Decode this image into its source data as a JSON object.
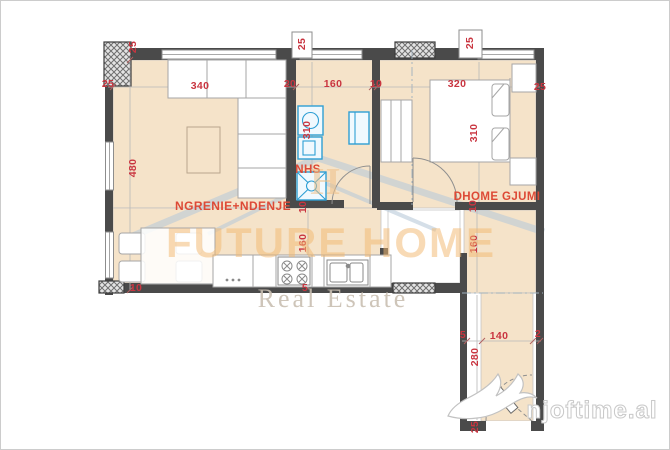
{
  "rooms": [
    {
      "id": "living-dining",
      "label": "NGRENIE+NDENJE",
      "x": 233,
      "y": 206
    },
    {
      "id": "bathroom",
      "label": "NHS",
      "x": 308,
      "y": 170
    },
    {
      "id": "bedroom",
      "label": "DHOME GJUMI",
      "x": 497,
      "y": 197
    }
  ],
  "dimension_labels": [
    {
      "text": "25",
      "x": 133,
      "y": 47,
      "rotated": true
    },
    {
      "text": "25",
      "x": 108,
      "y": 84,
      "rotated": false
    },
    {
      "text": "340",
      "x": 200,
      "y": 86,
      "rotated": false
    },
    {
      "text": "20",
      "x": 290,
      "y": 84,
      "rotated": false
    },
    {
      "text": "160",
      "x": 333,
      "y": 84,
      "rotated": false
    },
    {
      "text": "10",
      "x": 376,
      "y": 84,
      "rotated": false
    },
    {
      "text": "25",
      "x": 302,
      "y": 44,
      "rotated": true
    },
    {
      "text": "25",
      "x": 470,
      "y": 43,
      "rotated": true
    },
    {
      "text": "320",
      "x": 457,
      "y": 84,
      "rotated": false
    },
    {
      "text": "25",
      "x": 540,
      "y": 87,
      "rotated": false
    },
    {
      "text": "480",
      "x": 133,
      "y": 168,
      "rotated": true
    },
    {
      "text": "310",
      "x": 307,
      "y": 130,
      "rotated": true
    },
    {
      "text": "310",
      "x": 474,
      "y": 133,
      "rotated": true
    },
    {
      "text": "10",
      "x": 303,
      "y": 207,
      "rotated": true
    },
    {
      "text": "10",
      "x": 473,
      "y": 206,
      "rotated": true
    },
    {
      "text": "160",
      "x": 303,
      "y": 243,
      "rotated": true
    },
    {
      "text": "160",
      "x": 474,
      "y": 244,
      "rotated": true
    },
    {
      "text": "10",
      "x": 136,
      "y": 288,
      "rotated": false
    },
    {
      "text": "5",
      "x": 305,
      "y": 288,
      "rotated": false
    },
    {
      "text": "5",
      "x": 463,
      "y": 335,
      "rotated": false
    },
    {
      "text": "140",
      "x": 499,
      "y": 336,
      "rotated": false
    },
    {
      "text": "2",
      "x": 538,
      "y": 334,
      "rotated": false
    },
    {
      "text": "280",
      "x": 475,
      "y": 357,
      "rotated": true
    },
    {
      "text": "25",
      "x": 475,
      "y": 427,
      "rotated": true
    }
  ],
  "watermarks": {
    "brand_title": "FUTURE HOME",
    "brand_monogram": "H",
    "brand_subtitle": "Real Estate",
    "site": "njoftime.al"
  },
  "colors": {
    "floor": "#f5e3c9",
    "wall": "#4a4a4a",
    "dimension_text": "#c93540",
    "room_label": "#dd4a36",
    "fixture": "#2e9fd4",
    "watermark_orange": "rgba(242,184,113,0.52)",
    "watermark_gray": "rgba(201,191,177,0.9)",
    "watermark_roof": "rgba(185,201,216,0.6)"
  }
}
